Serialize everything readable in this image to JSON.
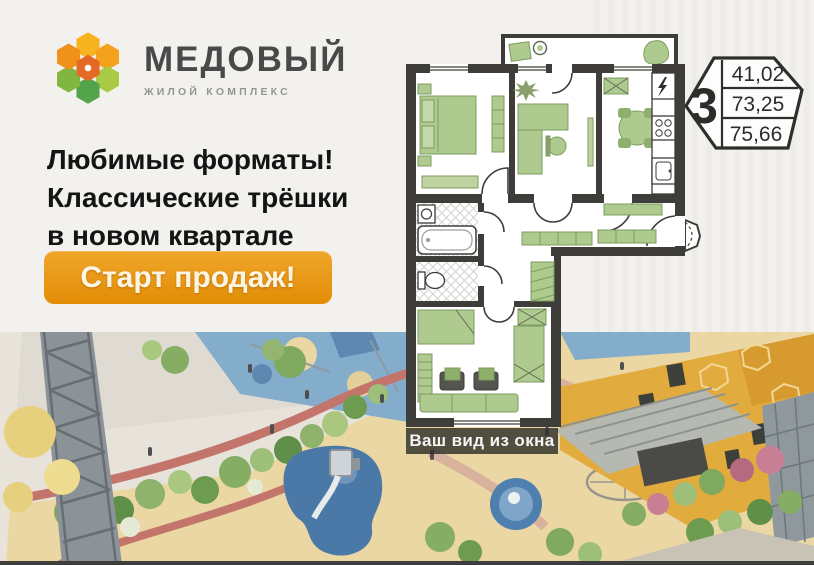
{
  "brand": {
    "name": "МЕДОВЫЙ",
    "tagline": "ЖИЛОЙ КОМПЛЕКС"
  },
  "headline": {
    "lines": [
      "Любимые форматы!",
      "Классические трёшки",
      "в новом квартале"
    ]
  },
  "cta_label": "Старт продаж!",
  "badge": {
    "rooms": "3",
    "area_values": [
      "41,02",
      "73,25",
      "75,66"
    ]
  },
  "plan": {
    "window_view_label": "Ваш вид из окна"
  },
  "colors": {
    "accent_orange": "#e8940e",
    "plan_wall": "#3e3d39",
    "furniture_green": "#aeca8e",
    "sand": "#ead7a3",
    "play_blue": "#84adcb",
    "building_yellow": "#e2ab3e"
  }
}
